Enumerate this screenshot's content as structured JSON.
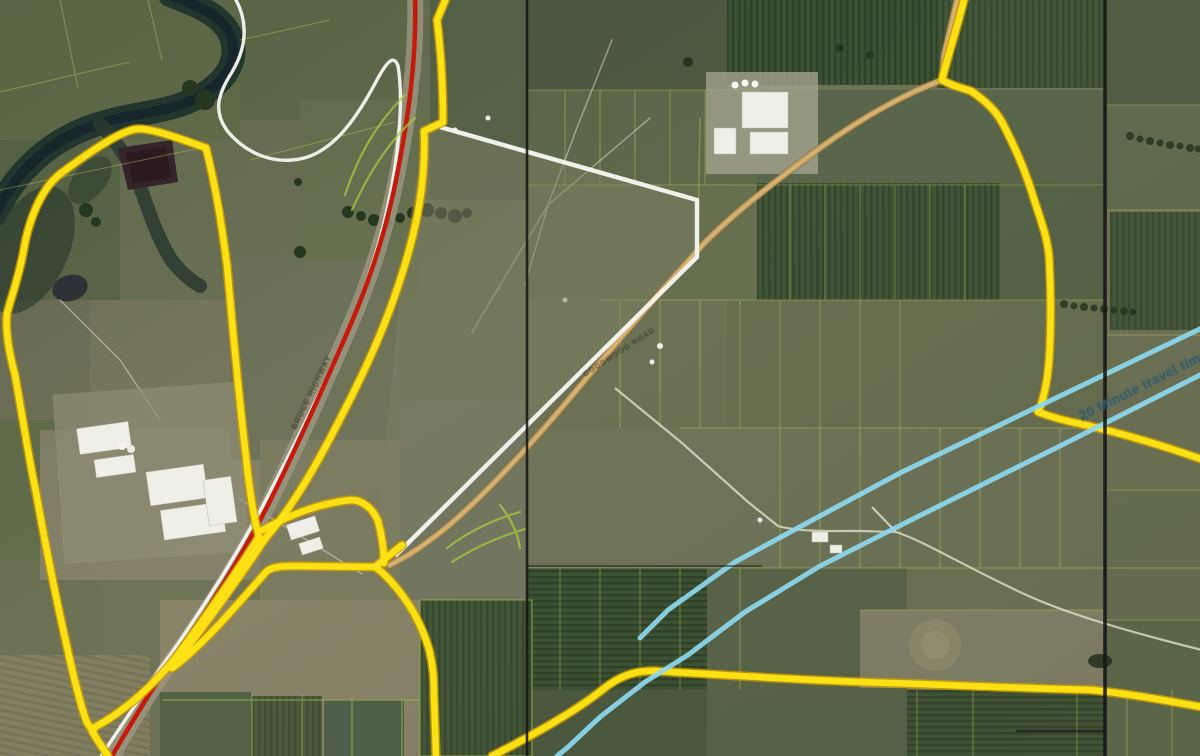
{
  "map": {
    "labels": {
      "travel_time": "20 Minute travel time",
      "highway": "BRUCE HIGHWAY",
      "connecting_road": "GOODWOOD ROAD"
    },
    "colors": {
      "boundary_yellow": "#ffe315",
      "boundary_yellow_edge": "#cf9e00",
      "highway_red": "#c41a0a",
      "road_white": "#f7f7f2",
      "parcel_white": "#f5f5ef",
      "isochrone_cyan": "#8bd8f0",
      "isochrone_text": "#2b5a72",
      "cadastre_black": "#161616",
      "road_tan": "#c9a263"
    },
    "features": {
      "yellow_lines": "urban footprint boundary",
      "red_line": "highlighted highway corridor",
      "white_polygon": "subject land parcel",
      "cyan_lines": "20 minute travel time contour",
      "black_lines": "cadastral frame lines",
      "background": "aerial imagery of cane farmland, river and sugar mill"
    }
  }
}
